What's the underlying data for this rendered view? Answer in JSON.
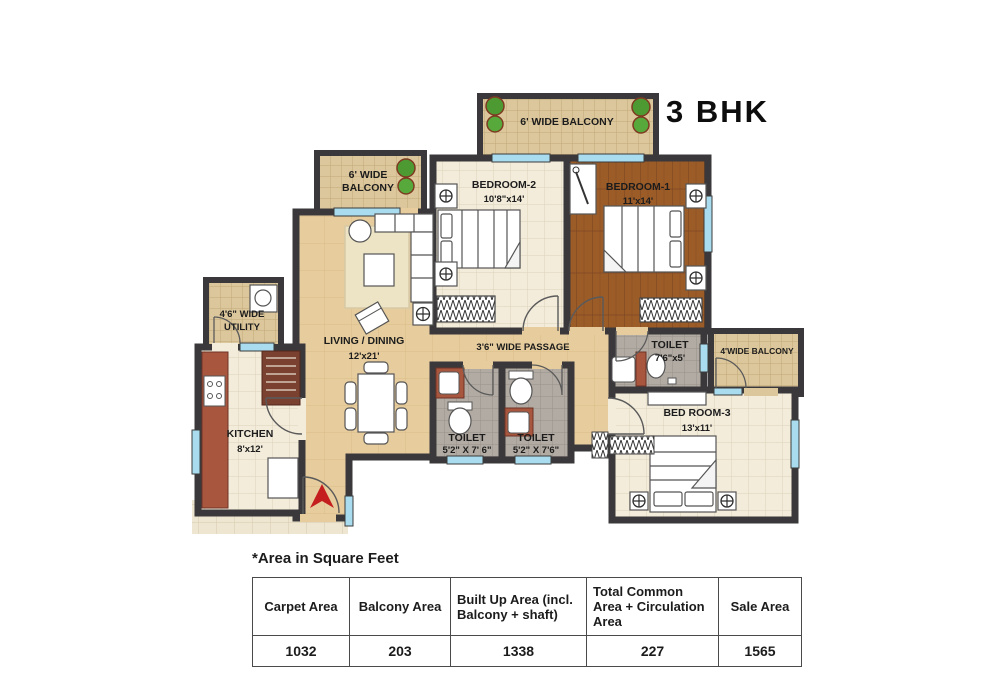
{
  "title": "3 BHK",
  "area_note": "*Area in Square Feet",
  "rooms": {
    "balcony_top": "6' WIDE BALCONY",
    "balcony_left_l1": "6' WIDE",
    "balcony_left_l2": "BALCONY",
    "balcony_right": "4'WIDE BALCONY",
    "bedroom2_name": "BEDROOM-2",
    "bedroom2_dims": "10'8\"x14'",
    "bedroom1_name": "BEDROOM-1",
    "bedroom1_dims": "11'x14'",
    "bedroom3_name": "BED ROOM-3",
    "bedroom3_dims": "13'x11'",
    "living_name": "LIVING / DINING",
    "living_dims": "12'x21'",
    "passage": "3'6\" WIDE PASSAGE",
    "kitchen_name": "KITCHEN",
    "kitchen_dims": "8'x12'",
    "utility_l1": "4'6\" WIDE",
    "utility_l2": "UTILITY",
    "toilet_master_name": "TOILET",
    "toilet_master_dims": "7'6\"x5'",
    "toilet1_name": "TOILET",
    "toilet1_dims": "5'2\" X 7' 6\"",
    "toilet2_name": "TOILET",
    "toilet2_dims": "5'2\" X 7'6\""
  },
  "table": {
    "headers": [
      "Carpet Area",
      "Balcony Area",
      "Built Up Area (incl. Balcony + shaft)",
      "Total Common Area + Circulation Area",
      "Sale Area"
    ],
    "values": [
      "1032",
      "203",
      "1338",
      "227",
      "1565"
    ]
  },
  "colors": {
    "wall": "#3a383a",
    "living_floor": "#e7cd9d",
    "bedroom1_wood": "#9c5c28",
    "tile_cream": "#f3ecdb",
    "tile_gray": "#b2aba3",
    "balcony_tile": "#dcc79c",
    "counter": "#a8563e",
    "window_glass": "#aadcef",
    "plant_green": "#4d9a33",
    "entry_arrow_red": "#c41e1e"
  }
}
